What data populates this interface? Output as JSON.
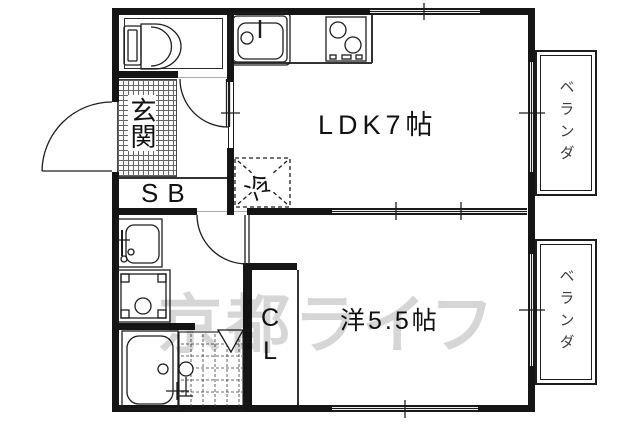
{
  "floorplan": {
    "type": "japanese-apartment-floor-plan",
    "rooms": {
      "ldk": {
        "label": "LDK7帖"
      },
      "western_room": {
        "label": "洋5.5帖"
      },
      "genkan": {
        "label": "玄関"
      },
      "shoe_box": {
        "label": "SB"
      },
      "closet": {
        "label": "C\nL"
      },
      "refrigerator_space": {
        "label": "冷"
      },
      "balcony_top": {
        "label": "ベランダ"
      },
      "balcony_bottom": {
        "label": "ベランダ"
      }
    },
    "watermark": {
      "text": "京都ライフ"
    },
    "fixtures_shown": [
      "toilet",
      "kitchen-sink",
      "gas-stove",
      "refrigerator-space",
      "washbasin",
      "washing-machine-pan",
      "bathtub",
      "shower-floor",
      "entrance-door-swing",
      "toilet-door-swing",
      "washroom-door-swing",
      "sliding-partition",
      "windows"
    ],
    "colors": {
      "wall": "#151515",
      "line": "#222222",
      "window_fill": "#ececec",
      "watermark": "#b5b5b5"
    }
  }
}
